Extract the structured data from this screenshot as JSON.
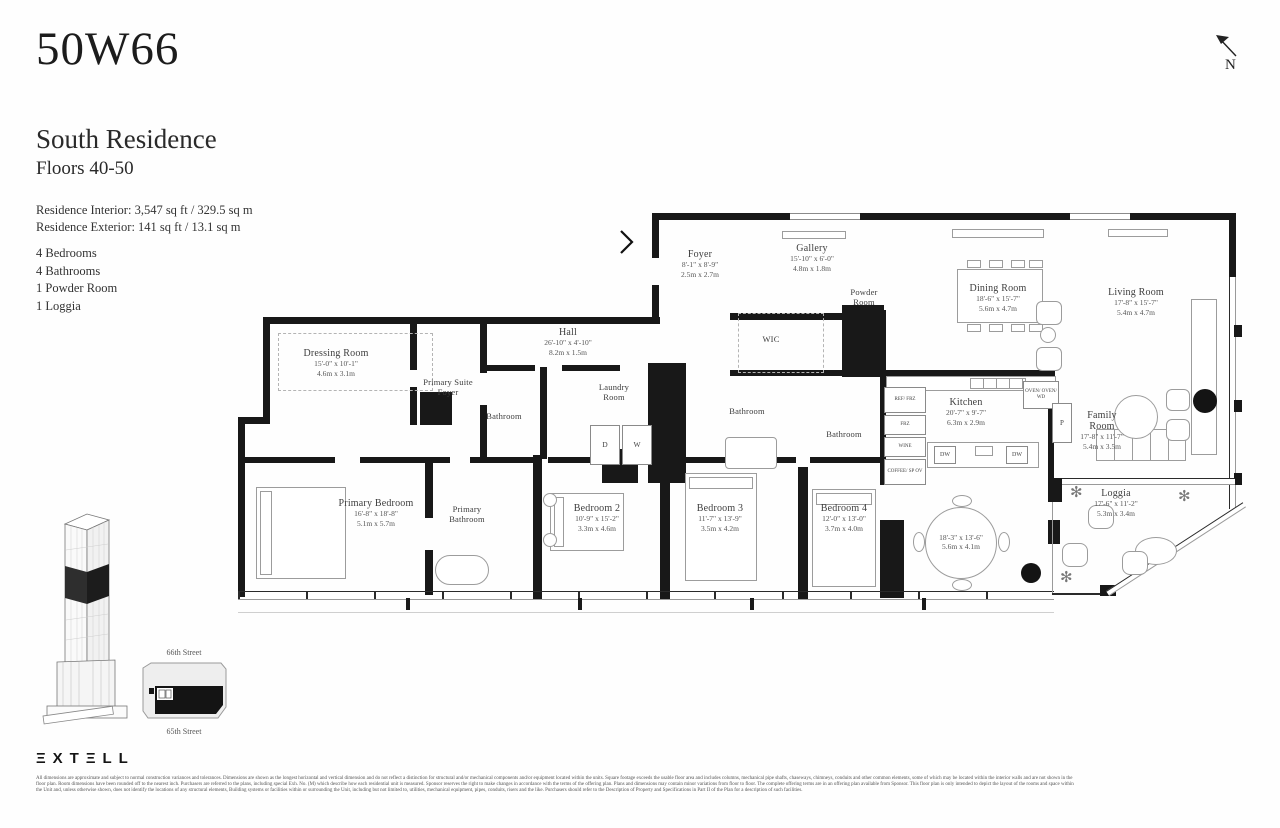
{
  "header": {
    "building": "50W66",
    "residence_name": "South Residence",
    "floors": "Floors 40-50",
    "interior_area": "Residence Interior: 3,547 sq ft / 329.5 sq m",
    "exterior_area": "Residence Exterior: 141 sq ft / 13.1 sq m",
    "features": [
      "4 Bedrooms",
      "4 Bathrooms",
      "1 Powder Room",
      "1 Loggia"
    ]
  },
  "compass": {
    "label": "N"
  },
  "plan": {
    "rooms": [
      {
        "name": "Foyer",
        "ft": "8'-1\" x 8'-9\"",
        "m": "2.5m x 2.7m"
      },
      {
        "name": "Gallery",
        "ft": "15'-10\" x 6'-0\"",
        "m": "4.8m x 1.8m"
      },
      {
        "name": "WIC"
      },
      {
        "name": "Powder Room"
      },
      {
        "name": "Dining Room",
        "ft": "18'-6\" x 15'-7\"",
        "m": "5.6m x 4.7m"
      },
      {
        "name": "Living Room",
        "ft": "17'-8\" x 15'-7\"",
        "m": "5.4m x 4.7m"
      },
      {
        "name": "Hall",
        "ft": "26'-10\" x 4'-10\"",
        "m": "8.2m x 1.5m"
      },
      {
        "name": "Dressing Room",
        "ft": "15'-0\" x 10'-1\"",
        "m": "4.6m x 3.1m"
      },
      {
        "name": "Primary Suite Foyer"
      },
      {
        "name": "Bathroom"
      },
      {
        "name": "Laundry Room"
      },
      {
        "name": "Bathroom"
      },
      {
        "name": "Bathroom"
      },
      {
        "name": "Kitchen",
        "ft": "20'-7\" x 9'-7\"",
        "m": "6.3m x 2.9m"
      },
      {
        "name": "Family Room",
        "ft": "17'-8\" x 11'-7\"",
        "m": "5.4m x 3.5m"
      },
      {
        "name": "Primary Bedroom",
        "ft": "16'-8\" x 18'-8\"",
        "m": "5.1m x 5.7m"
      },
      {
        "name": "Primary Bathroom"
      },
      {
        "name": "Bedroom 2",
        "ft": "10'-9\" x 15'-2\"",
        "m": "3.3m x 4.6m"
      },
      {
        "name": "Bedroom 3",
        "ft": "11'-7\" x 13'-9\"",
        "m": "3.5m x 4.2m"
      },
      {
        "name": "Bedroom 4",
        "ft": "12'-0\" x 13'-0\"",
        "m": "3.7m x 4.0m"
      },
      {
        "name": "",
        "ft": "18'-3\" x 13'-6\"",
        "m": "5.6m x 4.1m"
      },
      {
        "name": "Loggia",
        "ft": "17'-6\" x 11'-2\"",
        "m": "5.3m x 3.4m"
      }
    ],
    "appliances": {
      "column": [
        "REF/ FRZ",
        "FRZ",
        "WINE",
        "COFFEE/ SP OV"
      ],
      "wall_ovens": "OVEN/ OVEN/ WD",
      "pantry": "P",
      "island": [
        "DW",
        "DW"
      ],
      "laundry": [
        "D",
        "W"
      ]
    }
  },
  "keyplan": {
    "street_top": "66th Street",
    "street_bottom": "65th Street"
  },
  "footer": {
    "brand": "ΞXTΞLL",
    "disclaimer": [
      "All dimensions are approximate and subject to normal construction variances and tolerances. Dimensions are shown as the longest horizontal and vertical dimension and do not reflect a distinction for structural and/or mechanical components and/or equipment located within the units. Square footage exceeds the usable floor area and includes columns, mechanical pipe shafts, chaseways, chimneys, conduits and other common elements, some of which may be located within the interior walls and are not shown in the",
      "floor plan. Room dimensions have been rounded off to the nearest inch. Purchasers are referred to the plans, including special Exh. No. (M) which describe how each residential unit is measured. Sponsor reserves the right to make changes in accordance with the terms of the offering plan. Plans and dimensions may contain minor variations from floor to floor. The complete offering terms are in an offering plan available from Sponsor. This floor plan is only intended to depict the layout of the rooms and space within",
      "the Unit and, unless otherwise shown, does not identify the locations of any structural elements, Building systems or facilities within or surrounding the Unit, including but not limited to, utilities, mechanical equipment, pipes, conduits, risers and the like. Purchasers should refer to the Description of Property and Specifications in Part II of the Plan for a description of such facilities."
    ]
  }
}
